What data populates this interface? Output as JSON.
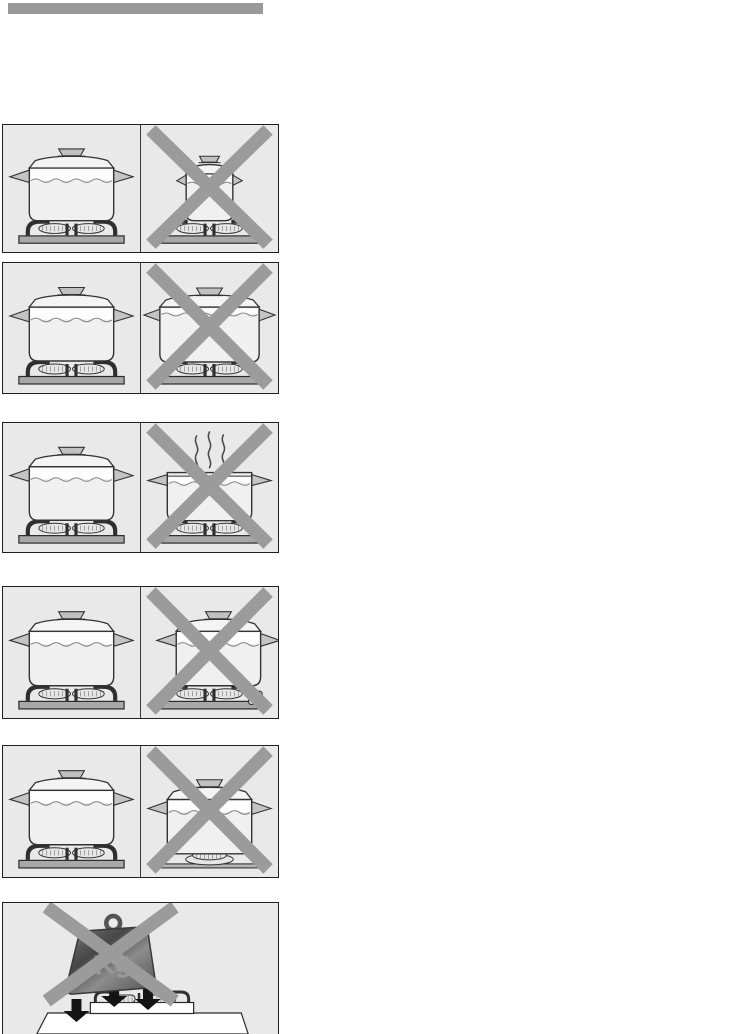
{
  "document": {
    "kind": "appliance-manual-safety-illustration-page"
  },
  "header": {
    "bar": "solid-gray-title-bar"
  },
  "weight": {
    "label": "Kg"
  },
  "colors": {
    "header-bar": "#9a9a9a",
    "panel-bg": "#e9e9e9",
    "panel-border": "#1f1f1f",
    "cross": "#9b9b9b",
    "ink": "#333333",
    "pot-fill": "#f0f0f0",
    "water-band": "#fdfdfd",
    "metal": "#a8a8a8",
    "arrow": "#141414"
  },
  "icons": [
    {
      "name": "prohibition-cross-icon",
      "shape": "two-diagonal-gray-bars"
    },
    {
      "name": "steam-icon",
      "shape": "three-wavy-lines"
    },
    {
      "name": "down-arrow-icon",
      "shape": "solid-black-down-arrow"
    },
    {
      "name": "kg-weight-icon",
      "shape": "tilted-trapezoid-weight-with-ring"
    }
  ],
  "panels": [
    {
      "name": "pan-size",
      "left": "correct-pan-covers-burner",
      "right": "too-small-pan-crossed-out"
    },
    {
      "name": "pan-width",
      "left": "correct-pan-on-pan-support",
      "right": "oversized-overfull-pan-crossed-out"
    },
    {
      "name": "pan-lid",
      "left": "pan-with-lid",
      "right": "pan-without-lid-steam-escaping-crossed-out"
    },
    {
      "name": "pan-position",
      "left": "pan-centred-on-burner",
      "right": "pan-offset-over-control-knob-crossed-out"
    },
    {
      "name": "pan-support",
      "left": "pan-on-pan-support",
      "right": "pan-directly-on-burner-crossed-out"
    },
    {
      "name": "heavy-objects",
      "scene": "kg-weight-dropping-on-hob-crossed-out"
    }
  ]
}
